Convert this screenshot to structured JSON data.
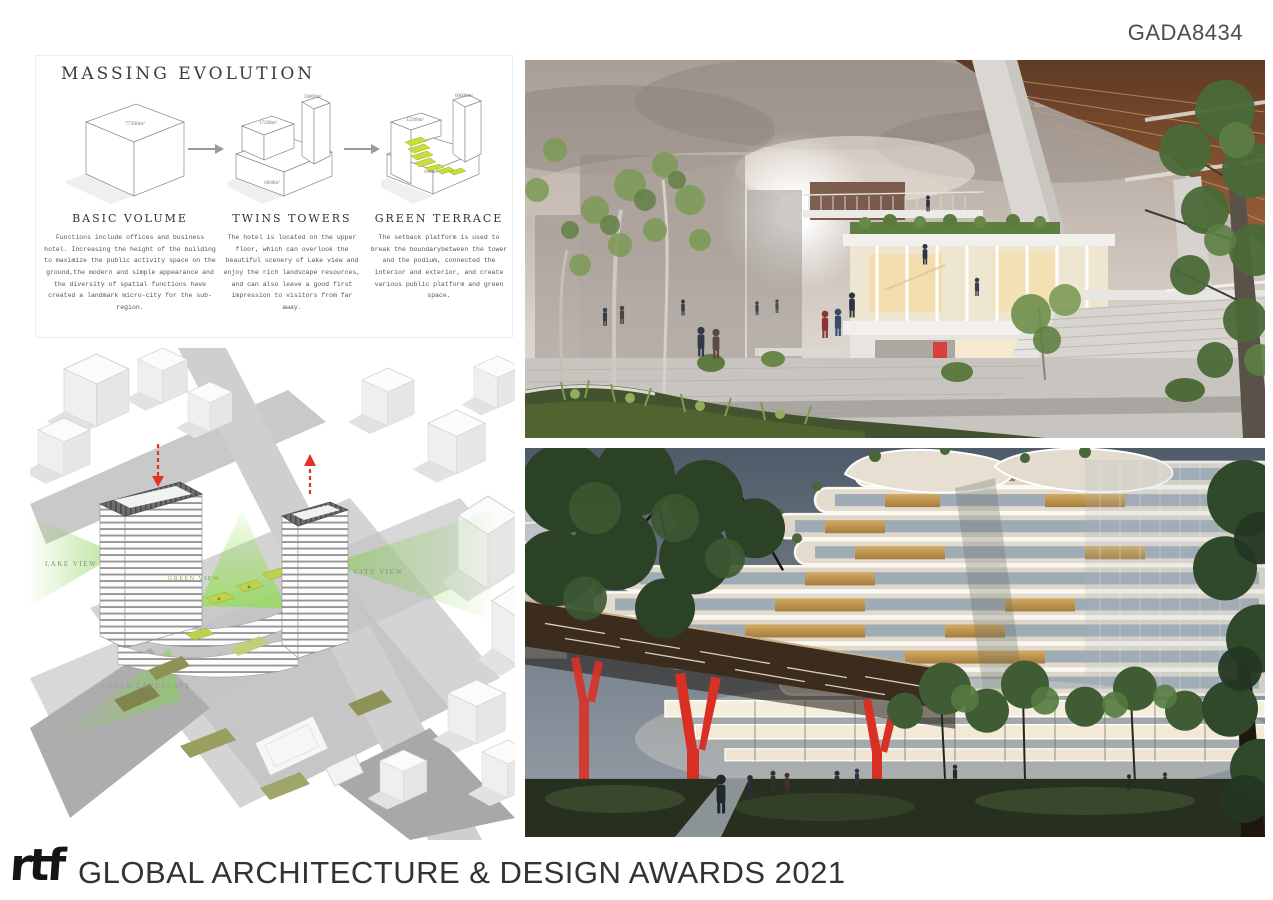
{
  "page": {
    "id_tag": "GADA8434"
  },
  "massing_panel": {
    "title": "MASSING EVOLUTION",
    "stages": [
      {
        "name": "BASIC VOLUME",
        "area_labels": [
          "77200m²"
        ],
        "description": "Functions include offices and business hotel. Increasing the height of the building to maximize the public activity space on the ground,the modern and simple appearance and the diversity of spatial functions have created a landmark micro-city for the sub-region."
      },
      {
        "name": "TWINS TOWERS",
        "area_labels": [
          "17200m²",
          "59000m²",
          "6000m²"
        ],
        "description": "The hotel is located on the upper floor, which can overlook the beautiful scenery of Lake view and enjoy the rich landscape resources, and can also leave a good first impression to visitors from far away."
      },
      {
        "name": "GREEN TERRACE",
        "area_labels": [
          "12200m²",
          "60000m²",
          "5000m²"
        ],
        "description": "The setback platform is used to break the boundarybetween the tower and the podium, connected the interior and exterior, and create various public platform and green space."
      }
    ]
  },
  "site_diagram": {
    "labels": {
      "lake_view": "LAKE VIEW",
      "green_view": "GREEN VIEW",
      "city_view": "CITY VIEW",
      "green_landscape": "GREEN LANDSCAPE"
    }
  },
  "footer": {
    "logo": "rtf",
    "title": "GLOBAL ARCHITECTURE & DESIGN AWARDS 2021"
  },
  "colors": {
    "accent_green": "#c3d82e",
    "accent_red": "#e03226",
    "copper": "#8a5434",
    "warm_sky": "#c3b9b1",
    "dusk_sky": "#5c6875"
  }
}
